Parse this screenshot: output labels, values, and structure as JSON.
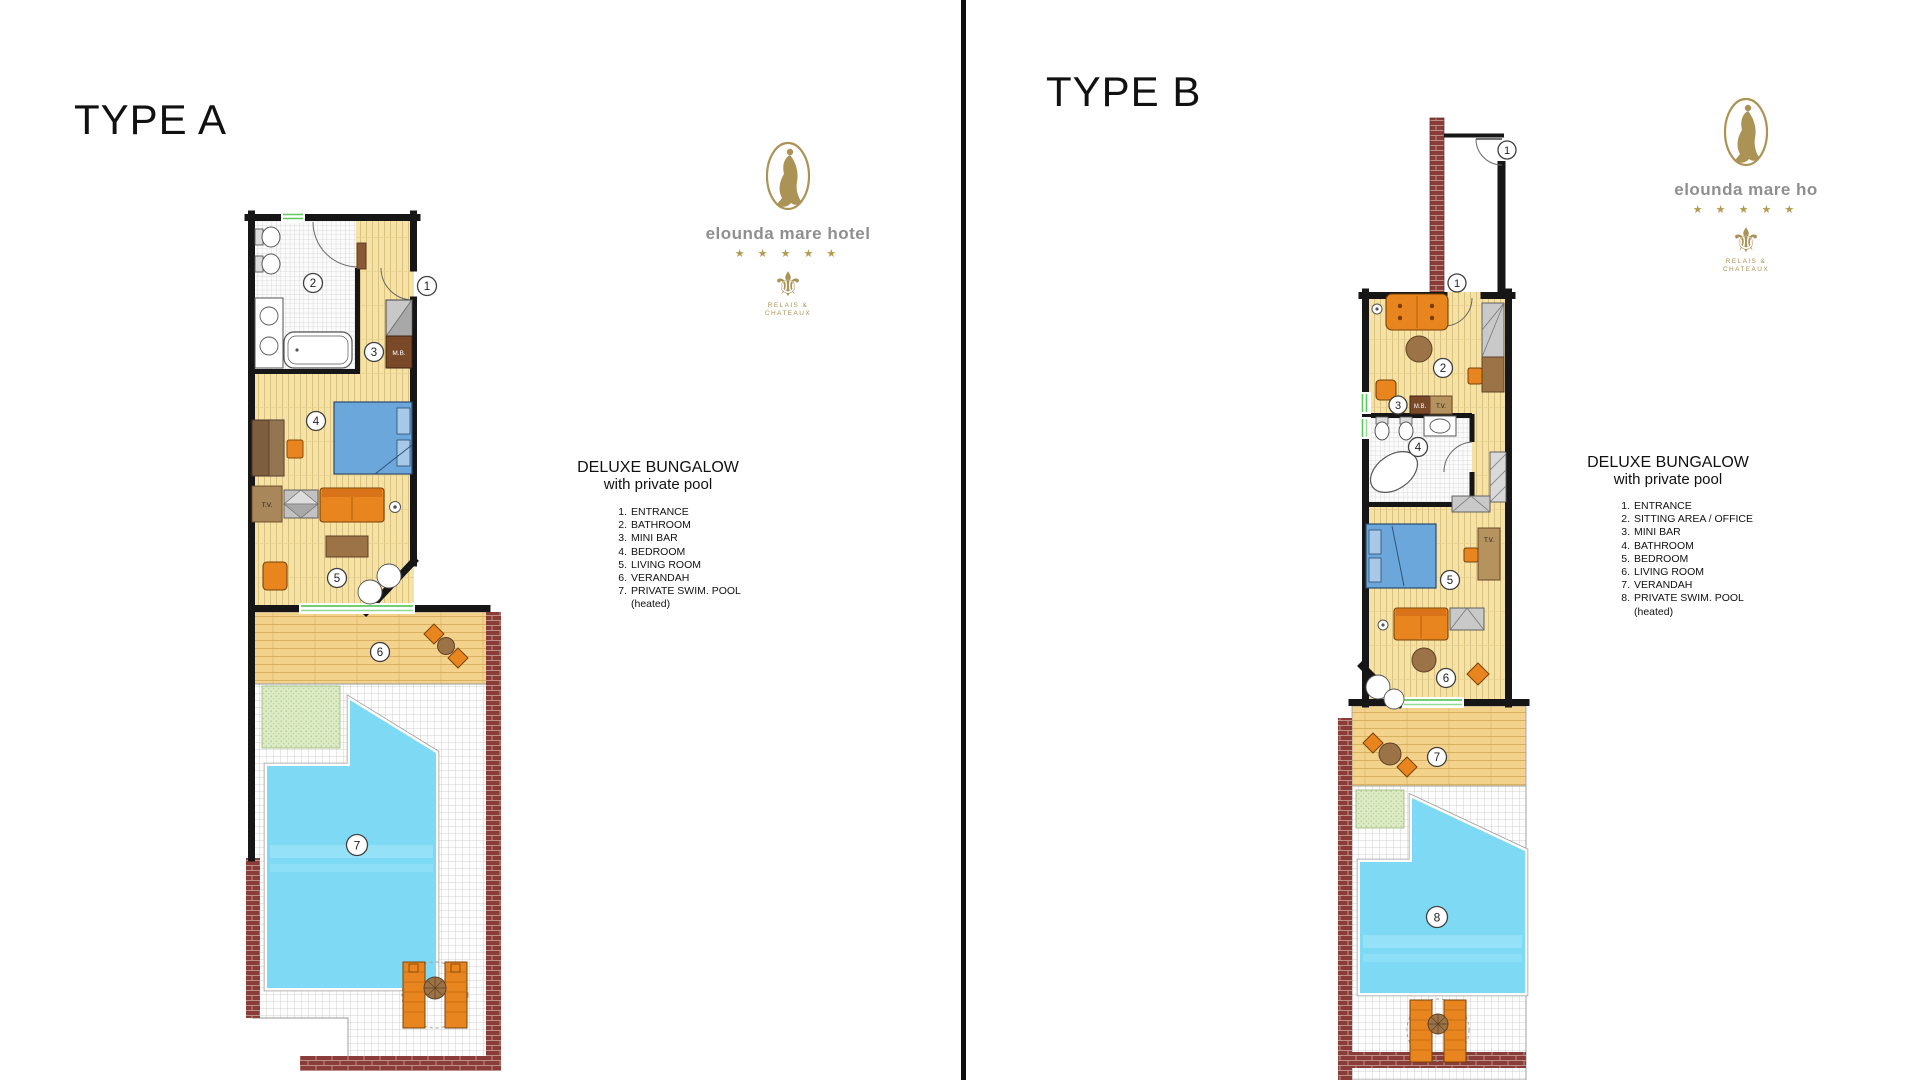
{
  "divider": {
    "color": "#0d0d0d"
  },
  "type_a": {
    "title": "TYPE A",
    "rooms": {
      "n1": "1",
      "n2": "2",
      "n3": "3",
      "n4": "4",
      "n5": "5",
      "n6": "6",
      "n7": "7"
    },
    "units": {
      "minibar": "M.B.",
      "tv": "T.V."
    },
    "legend": {
      "title": "DELUXE BUNGALOW",
      "subtitle": "with private pool",
      "items": [
        {
          "num": "1.",
          "label": "ENTRANCE"
        },
        {
          "num": "2.",
          "label": "BATHROOM"
        },
        {
          "num": "3.",
          "label": "MINI BAR"
        },
        {
          "num": "4.",
          "label": "BEDROOM"
        },
        {
          "num": "5.",
          "label": "LIVING ROOM"
        },
        {
          "num": "6.",
          "label": "VERANDAH"
        },
        {
          "num": "7.",
          "label": "PRIVATE SWIM. POOL",
          "note": "(heated)"
        }
      ]
    },
    "logo": {
      "hotel_name": "elounda mare hotel",
      "stars": "★ ★ ★ ★ ★",
      "emblem": "⚜",
      "relais_line1": "RELAIS &",
      "relais_line2": "CHATEAUX"
    }
  },
  "type_b": {
    "title": "TYPE B",
    "rooms": {
      "entrance_outer": "1",
      "entrance_inner": "1",
      "n2": "2",
      "n3": "3",
      "n4": "4",
      "n5": "5",
      "n6": "6",
      "n7": "7",
      "n8": "8"
    },
    "units": {
      "minibar": "M.B.",
      "tv_sitting": "T.V.",
      "tv_bedroom": "T.V."
    },
    "legend": {
      "title": "DELUXE BUNGALOW",
      "subtitle": "with private pool",
      "items": [
        {
          "num": "1.",
          "label": "ENTRANCE"
        },
        {
          "num": "2.",
          "label": "SITTING AREA / OFFICE"
        },
        {
          "num": "3.",
          "label": "MINI BAR"
        },
        {
          "num": "4.",
          "label": "BATHROOM"
        },
        {
          "num": "5.",
          "label": "BEDROOM"
        },
        {
          "num": "6.",
          "label": "LIVING ROOM"
        },
        {
          "num": "7.",
          "label": "VERANDAH"
        },
        {
          "num": "8.",
          "label": "PRIVATE SWIM. POOL",
          "note": "(heated)"
        }
      ]
    },
    "logo": {
      "hotel_name": "elounda mare ho",
      "stars": "★ ★ ★ ★ ★",
      "emblem": "⚜",
      "relais_line1": "RELAIS &",
      "relais_line2": "CHATEAUX"
    }
  },
  "colors": {
    "pool": "#7ed9f5",
    "wall": "#161616",
    "brick": "#8a3c38",
    "wood": "#f4e2a6",
    "verandah_wood": "#f3d28c",
    "orange": "#e8851e",
    "bed_blue": "#6ba7da",
    "gold": "#ab9255",
    "grass": "#dcebc4"
  }
}
